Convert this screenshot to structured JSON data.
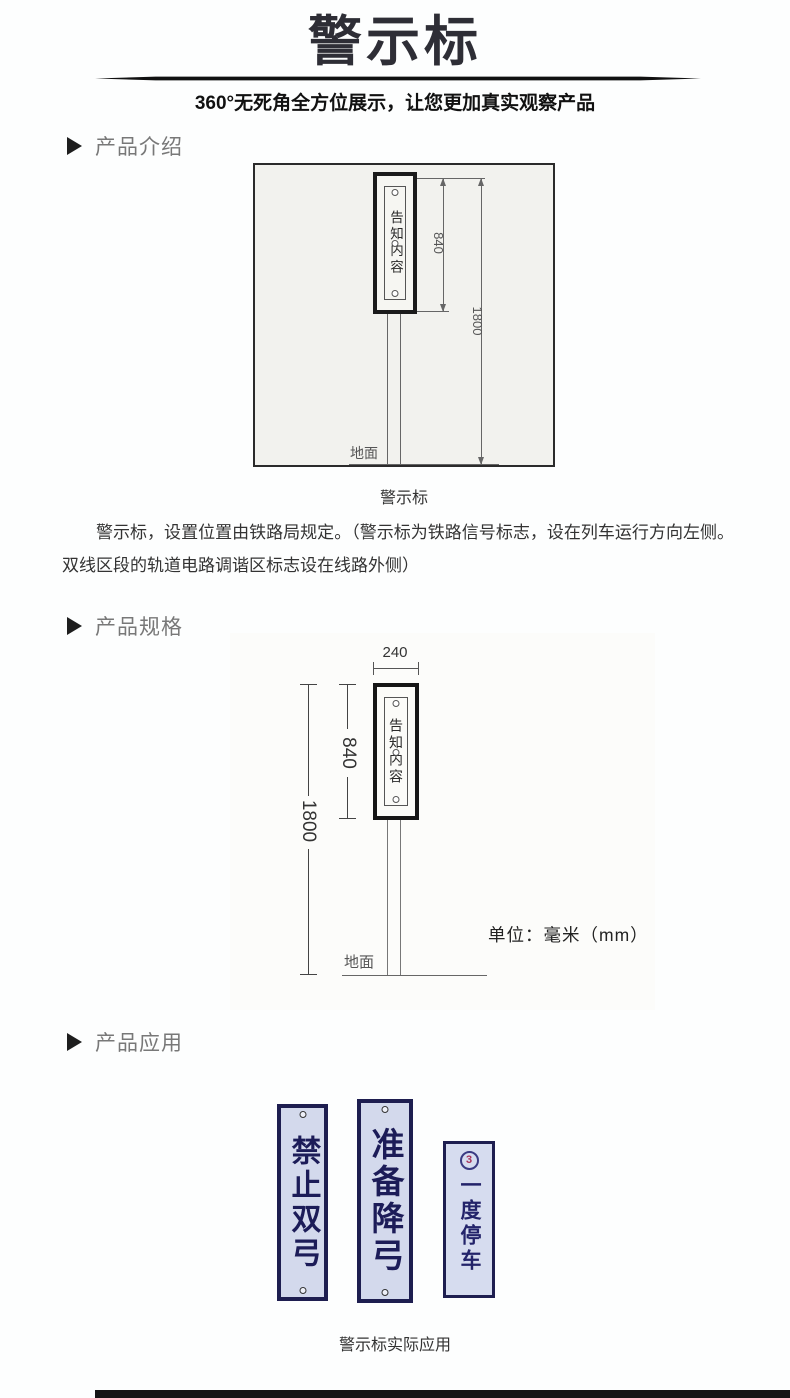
{
  "page": {
    "title": "警示标",
    "subtitle": "360°无死角全方位展示，让您更加真实观察产品"
  },
  "sections": {
    "intro": {
      "label": "产品介绍"
    },
    "spec": {
      "label": "产品规格"
    },
    "app": {
      "label": "产品应用"
    }
  },
  "diagram1": {
    "sign_text": "告知内容",
    "dim_height_sign": "840",
    "dim_height_total": "1800",
    "ground_label": "地面",
    "caption": "警示标"
  },
  "intro_paragraph": "警示标，设置位置由铁路局规定。（警示标为铁路信号标志，设在列车运行方向左侧。双线区段的轨道电路调谐区标志设在线路外侧）",
  "diagram2": {
    "sign_text": "告知内容",
    "dim_width": "240",
    "dim_height_sign": "840",
    "dim_height_total": "1800",
    "ground_label": "地面",
    "unit_note": "单位：毫米（mm）"
  },
  "application": {
    "signs": [
      {
        "text": "禁止双弓"
      },
      {
        "text": "准备降弓"
      },
      {
        "text": "一度停车",
        "badge": "3"
      }
    ],
    "caption": "警示标实际应用"
  },
  "colors": {
    "accent_navy": "#1e1e50",
    "sign_background": "#d3d9ec",
    "badge_red": "#a8325a",
    "divider_black": "#111111"
  }
}
